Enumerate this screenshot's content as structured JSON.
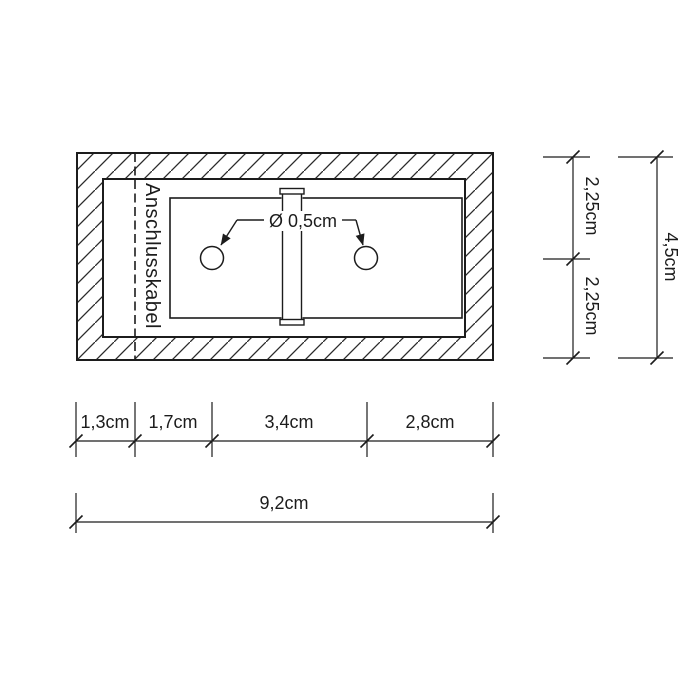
{
  "meta": {
    "background_color": "#ffffff",
    "ink_color": "#1c1c1c",
    "drawing_type": "technical-section-drawing"
  },
  "drawing": {
    "cable_label": "Anschlusskabel",
    "diameter_label": "Ø 0,5cm",
    "hole_count": 2
  },
  "dimensions": {
    "right": {
      "upper": "2,25cm",
      "lower": "2,25cm",
      "total": "4,5cm"
    },
    "bottom": {
      "segments": [
        "1,3cm",
        "1,7cm",
        "3,4cm",
        "2,8cm"
      ],
      "total": "9,2cm"
    }
  }
}
